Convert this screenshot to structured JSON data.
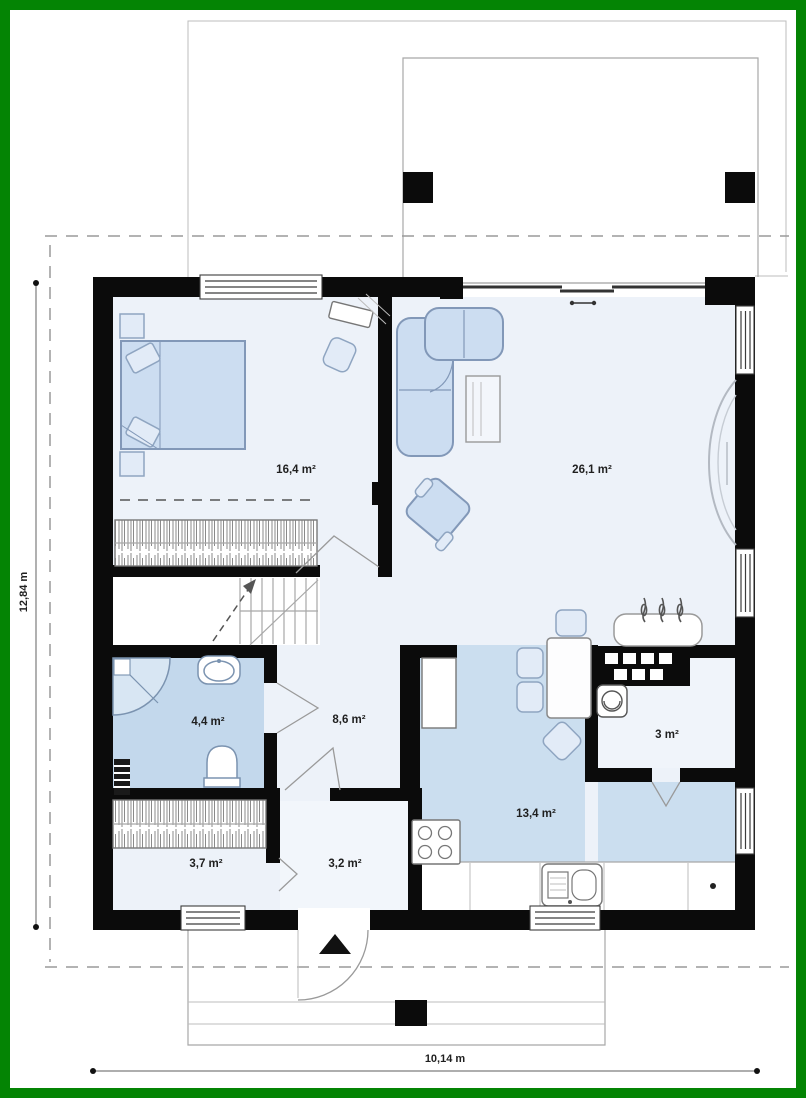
{
  "plan": {
    "rooms": [
      {
        "id": "bedroom",
        "area": "16,4 m²"
      },
      {
        "id": "living-room",
        "area": "26,1 m²"
      },
      {
        "id": "bathroom",
        "area": "4,4 m²"
      },
      {
        "id": "hall",
        "area": "8,6 m²"
      },
      {
        "id": "pantry",
        "area": "3 m²"
      },
      {
        "id": "kitchen",
        "area": "13,4 m²"
      },
      {
        "id": "wardrobe",
        "area": "3,7 m²"
      },
      {
        "id": "vestibule",
        "area": "3,2 m²"
      }
    ],
    "dimensions": {
      "height": "12,84 m",
      "width": "10,14 m"
    },
    "colors": {
      "frame_green": "#048404",
      "wall_black": "#0b0b0b",
      "room_light": "#edf2f9",
      "room_blue": "#c6d9ec",
      "furniture_blue": "#ccddf1",
      "site_line_gray": "#a8a8a8"
    }
  }
}
